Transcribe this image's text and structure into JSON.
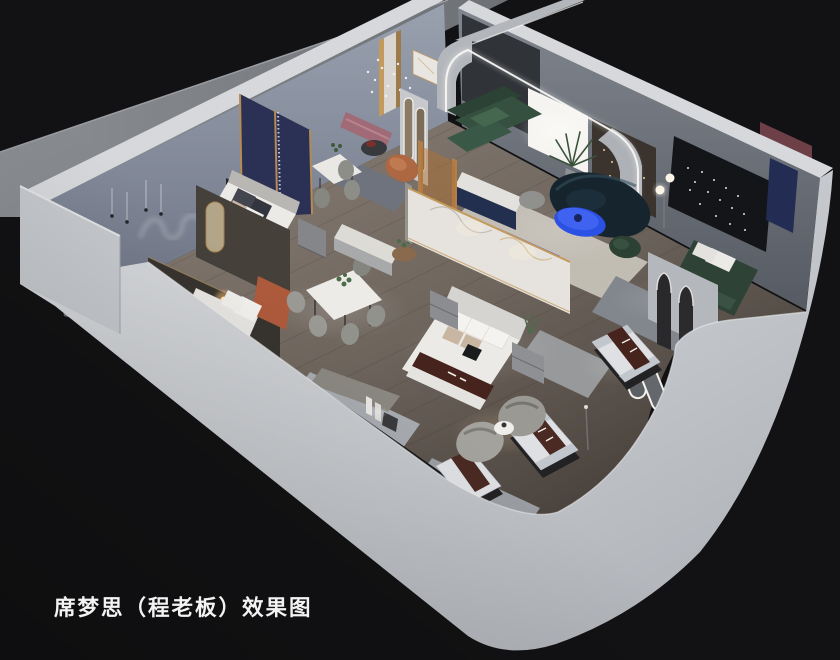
{
  "image": {
    "kind": "3d-interior-showroom-render",
    "view": "isometric-cutaway"
  },
  "caption": {
    "text": "席梦思（程老板）效果图"
  },
  "colors": {
    "background": "#121214",
    "exterior_wall": "#c9ccd1",
    "wall_top": "#d6d8db",
    "interior_wall_left": "#8c94a3",
    "interior_wall_right": "#70757e",
    "slab": "#85888d",
    "floor": "#7c736b",
    "floor_dark": "#3a342f",
    "led_strip": "#f7f6f2",
    "window_glow": "#f5f4f0",
    "sofa_green": "#35503f",
    "sofa_navy": "#16242e",
    "coffee_table_blue": "#2b50e4",
    "media_console_blue": "#3546d8",
    "accent_navy_panel": "#232c52",
    "accent_gold": "#c49a5c",
    "bench_pink": "#a06b76",
    "mattress_brown": "#46231c",
    "bedding_white": "#eceae7",
    "rug_cream": "#c6c2b8",
    "chair_gray": "#9a9993",
    "marble_white": "#e6e3de",
    "headboard_orange": "#ad5a3b",
    "black_panel": "#141518",
    "bronze_panel": "#3a332e",
    "partition_dark": "#37332e",
    "lamp_warm": "#ffc27d",
    "caption_text": "#f3f3f3"
  },
  "scene": {
    "elements": [
      "exterior-walkway-slab",
      "back-left-wall",
      "back-right-wall",
      "showroom-floor",
      "left-bedroom-display",
      "second-bedroom-display",
      "dining-display",
      "living-room-display",
      "right-bedroom-display",
      "front-bedroom-display",
      "mattress-display-row",
      "front-wall-cutaway",
      "caption"
    ]
  }
}
